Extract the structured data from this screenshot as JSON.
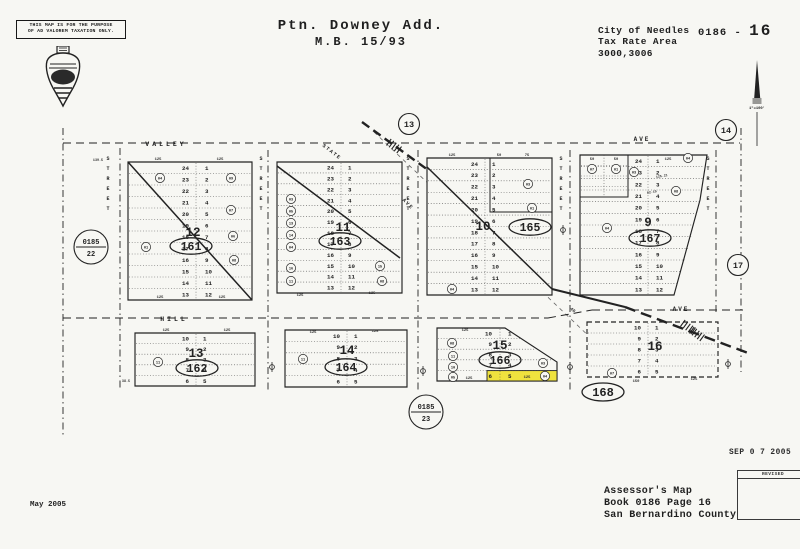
{
  "header": {
    "disclaimer": {
      "line1": "THIS MAP IS FOR THE PURPOSE",
      "line2": "OF AD VALOREM TAXATION ONLY."
    },
    "title": {
      "line1": "Ptn. Downey Add.",
      "line2": "M.B. 15/93"
    },
    "agency": [
      "City of Needles",
      "Tax Rate Area",
      "3000,3006"
    ],
    "sheet": {
      "prefix": "0186 -",
      "number": "16"
    }
  },
  "footer": {
    "date_note": "May 2005",
    "stamp_date": "SEP 0 7 2005",
    "revised_label": "REVISED",
    "credit": [
      "Assessor's Map",
      "Book 0186 Page 16",
      "San Bernardino County"
    ]
  },
  "map": {
    "ink": "#222222",
    "paper": "#f7f7f3",
    "highlight_color": "#efe23e",
    "scale_label": "1\"=100'",
    "streets": {
      "horizontal_labels": [
        {
          "text": "VALLEY",
          "x": 166,
          "y": 146,
          "size": 6.5,
          "ls": 3
        },
        {
          "text": "AVE",
          "x": 642,
          "y": 141,
          "size": 6,
          "ls": 2
        },
        {
          "text": "HILL",
          "x": 174,
          "y": 321,
          "size": 6.5,
          "ls": 3
        },
        {
          "text": "AVE",
          "x": 681,
          "y": 311,
          "size": 6,
          "ls": 2
        }
      ],
      "vertical_street_word": "STREET",
      "vertical_columns": [
        108,
        261,
        408,
        561,
        708
      ],
      "diagonal_labels": [
        {
          "text": "STATE",
          "x": 331,
          "y": 153,
          "rot": 38,
          "size": 5
        },
        {
          "text": "AVE",
          "x": 407,
          "y": 205,
          "rot": 45,
          "size": 5
        }
      ],
      "lines_h": [
        [
          63,
          143,
          740,
          143
        ],
        [
          63,
          318,
          548,
          318
        ],
        [
          548,
          318,
          592,
          310
        ],
        [
          592,
          310,
          744,
          310
        ]
      ],
      "lines_v": [
        [
          63,
          128,
          63,
          438
        ],
        [
          120,
          148,
          120,
          390
        ],
        [
          268,
          150,
          268,
          390
        ],
        [
          418,
          150,
          418,
          390
        ],
        [
          570,
          150,
          570,
          390
        ],
        [
          716,
          150,
          716,
          314
        ],
        [
          741,
          128,
          741,
          372
        ]
      ]
    },
    "diag_light": [
      [
        374,
        132
      ],
      [
        614,
        360
      ]
    ],
    "highway_solid": [
      [
        552,
        289
      ],
      [
        625,
        307
      ]
    ],
    "highway_dashed": [
      [
        625,
        307
      ],
      [
        748,
        353
      ]
    ],
    "rail_dashed": [
      [
        362,
        122
      ],
      [
        428,
        170
      ]
    ],
    "hatches": [
      {
        "x": 394,
        "y": 146,
        "a": 36
      },
      {
        "x": 688,
        "y": 327,
        "a": 36
      },
      {
        "x": 697,
        "y": 334,
        "a": 36
      }
    ],
    "symbols": [
      [
        272,
        367
      ],
      [
        423,
        371
      ],
      [
        570,
        367
      ],
      [
        728,
        364
      ],
      [
        563,
        230
      ]
    ],
    "node_circles": [
      {
        "label": "13",
        "x": 409,
        "y": 124
      },
      {
        "label": "14",
        "x": 726,
        "y": 130
      },
      {
        "label": "17",
        "x": 738,
        "y": 265
      }
    ],
    "ref_circles": [
      {
        "top": "0185",
        "bottom": "22",
        "x": 91,
        "y": 247
      },
      {
        "top": "0185",
        "bottom": "23",
        "x": 426,
        "y": 412
      }
    ],
    "oval_labels": [
      {
        "text": "168",
        "x": 603,
        "y": 392
      }
    ],
    "dims": [
      {
        "t": "125",
        "x": 158,
        "y": 160
      },
      {
        "t": "125",
        "x": 220,
        "y": 160
      },
      {
        "t": "139.5",
        "x": 98,
        "y": 161,
        "s": 3.4
      },
      {
        "t": "125",
        "x": 160,
        "y": 298
      },
      {
        "t": "125",
        "x": 222,
        "y": 298
      },
      {
        "t": "125",
        "x": 300,
        "y": 296
      },
      {
        "t": "125",
        "x": 372,
        "y": 294
      },
      {
        "t": "125",
        "x": 452,
        "y": 156
      },
      {
        "t": "50",
        "x": 499,
        "y": 156
      },
      {
        "t": "75",
        "x": 527,
        "y": 156
      },
      {
        "t": "50",
        "x": 592,
        "y": 160
      },
      {
        "t": "50",
        "x": 616,
        "y": 160
      },
      {
        "t": "125",
        "x": 668,
        "y": 160
      },
      {
        "t": "125.21",
        "x": 662,
        "y": 177,
        "r": -10,
        "s": 3.3
      },
      {
        "t": "82.15",
        "x": 652,
        "y": 193,
        "r": -10,
        "s": 3.3
      },
      {
        "t": "125",
        "x": 166,
        "y": 331
      },
      {
        "t": "125",
        "x": 227,
        "y": 331
      },
      {
        "t": "125",
        "x": 313,
        "y": 333
      },
      {
        "t": "125",
        "x": 375,
        "y": 332
      },
      {
        "t": "125",
        "x": 465,
        "y": 331
      },
      {
        "t": "125",
        "x": 469,
        "y": 379
      },
      {
        "t": "125",
        "x": 527,
        "y": 378
      },
      {
        "t": "150",
        "x": 636,
        "y": 382
      },
      {
        "t": "125",
        "x": 694,
        "y": 380
      },
      {
        "t": "40",
        "x": 572,
        "y": 311,
        "r": 40,
        "s": 4.5
      },
      {
        "t": "38.5",
        "x": 126,
        "y": 382,
        "s": 3.4
      }
    ],
    "blocks": [
      {
        "apn": "161",
        "block_no": "12",
        "style": "solid",
        "poly": [
          [
            128,
            162
          ],
          [
            252,
            162
          ],
          [
            252,
            300
          ],
          [
            128,
            300
          ]
        ],
        "top": 162,
        "bottom": 300,
        "gx1": 128,
        "gx2": 252,
        "cx": 196,
        "lx": 189,
        "rx": 205,
        "rows": [
          [
            "24",
            "1"
          ],
          [
            "23",
            "2"
          ],
          [
            "22",
            "3"
          ],
          [
            "21",
            "4"
          ],
          [
            "20",
            "5"
          ],
          [
            "19",
            "6"
          ],
          [
            "18",
            "7"
          ],
          [
            "17",
            "8"
          ],
          [
            "16",
            "9"
          ],
          [
            "15",
            "10"
          ],
          [
            "14",
            "11"
          ],
          [
            "13",
            "12"
          ]
        ],
        "ellipse": {
          "x": 191,
          "y": 246
        },
        "big": {
          "x": 193,
          "y": 236
        },
        "diag": [
          [
            128,
            162
          ],
          [
            252,
            300
          ]
        ],
        "circles": [
          {
            "t": "04",
            "x": 160,
            "y": 178
          },
          {
            "t": "09",
            "x": 231,
            "y": 178
          },
          {
            "t": "07",
            "x": 231,
            "y": 210
          },
          {
            "t": "06",
            "x": 233,
            "y": 236
          },
          {
            "t": "01",
            "x": 146,
            "y": 247
          },
          {
            "t": "08",
            "x": 234,
            "y": 260
          }
        ]
      },
      {
        "apn": "163",
        "block_no": "11",
        "style": "solid",
        "poly": [
          [
            277,
            162
          ],
          [
            402,
            162
          ],
          [
            402,
            293
          ],
          [
            277,
            293
          ]
        ],
        "top": 162,
        "bottom": 293,
        "gx1": 277,
        "gx2": 402,
        "cx": 341,
        "lx": 334,
        "rx": 348,
        "rows": [
          [
            "24",
            "1"
          ],
          [
            "23",
            "2"
          ],
          [
            "22",
            "3"
          ],
          [
            "21",
            "4"
          ],
          [
            "20",
            "5"
          ],
          [
            "19",
            "6"
          ],
          [
            "18",
            "7"
          ],
          [
            "17",
            "8"
          ],
          [
            "16",
            "9"
          ],
          [
            "15",
            "10"
          ],
          [
            "14",
            "11"
          ],
          [
            "13",
            "12"
          ]
        ],
        "ellipse": {
          "x": 340,
          "y": 241
        },
        "big": {
          "x": 343,
          "y": 231
        },
        "diag": [
          [
            277,
            166
          ],
          [
            400,
            258
          ]
        ],
        "circles": [
          {
            "t": "03",
            "x": 291,
            "y": 199
          },
          {
            "t": "05",
            "x": 291,
            "y": 211
          },
          {
            "t": "13",
            "x": 291,
            "y": 223
          },
          {
            "t": "14",
            "x": 291,
            "y": 235
          },
          {
            "t": "04",
            "x": 291,
            "y": 247
          },
          {
            "t": "16",
            "x": 291,
            "y": 268
          },
          {
            "t": "11",
            "x": 291,
            "y": 281
          },
          {
            "t": "15",
            "x": 380,
            "y": 266
          },
          {
            "t": "08",
            "x": 382,
            "y": 281
          }
        ]
      },
      {
        "apn": "165",
        "block_no": "10",
        "style": "solid",
        "poly": [
          [
            427,
            158
          ],
          [
            552,
            158
          ],
          [
            552,
            295
          ],
          [
            427,
            295
          ]
        ],
        "top": 158,
        "bottom": 295,
        "gx1": 427,
        "gx2": 552,
        "cx": 485,
        "lx": 478,
        "rx": 492,
        "rows": [
          [
            "24",
            "1"
          ],
          [
            "23",
            "2"
          ],
          [
            "22",
            "3"
          ],
          [
            "21",
            "4"
          ],
          [
            "20",
            "5"
          ],
          [
            "19",
            "6"
          ],
          [
            "18",
            "7"
          ],
          [
            "17",
            "8"
          ],
          [
            "16",
            "9"
          ],
          [
            "15",
            "10"
          ],
          [
            "14",
            "11"
          ],
          [
            "13",
            "12"
          ]
        ],
        "ellipse": {
          "x": 530,
          "y": 227
        },
        "big": {
          "x": 483,
          "y": 230
        },
        "diag": [
          [
            427,
            167
          ],
          [
            552,
            289
          ]
        ],
        "subrect": [
          490,
          158,
          62,
          54
        ],
        "circles": [
          {
            "t": "03",
            "x": 528,
            "y": 184
          },
          {
            "t": "01",
            "x": 532,
            "y": 208
          },
          {
            "t": "04",
            "x": 452,
            "y": 289
          }
        ]
      },
      {
        "apn": "167",
        "block_no": "9",
        "style": "solid",
        "poly": [
          [
            580,
            155
          ],
          [
            707,
            155
          ],
          [
            700,
            200
          ],
          [
            674,
            295
          ],
          [
            580,
            295
          ]
        ],
        "top": 155,
        "bottom": 295,
        "gx1": 580,
        "gx2": 707,
        "cx": 648,
        "lx": 642,
        "rx": 656,
        "row_x2": [
          705,
          705,
          704,
          702,
          699,
          696,
          693,
          689,
          686,
          682,
          679
        ],
        "rows": [
          [
            "24",
            "1"
          ],
          [
            "23",
            "2"
          ],
          [
            "22",
            "3"
          ],
          [
            "21",
            "4"
          ],
          [
            "20",
            "5"
          ],
          [
            "19",
            "6"
          ],
          [
            "18",
            "7"
          ],
          [
            "17",
            "8"
          ],
          [
            "16",
            "9"
          ],
          [
            "15",
            "10"
          ],
          [
            "14",
            "11"
          ],
          [
            "13",
            "12"
          ]
        ],
        "ellipse": {
          "x": 650,
          "y": 238
        },
        "big": {
          "x": 648,
          "y": 226
        },
        "subrect": [
          580,
          155,
          48,
          42
        ],
        "subdiv": 604,
        "subrows": [
          165.5,
          176,
          186.5
        ],
        "circles": [
          {
            "t": "07",
            "x": 592,
            "y": 169
          },
          {
            "t": "01",
            "x": 616,
            "y": 169
          },
          {
            "t": "03",
            "x": 634,
            "y": 172
          },
          {
            "t": "04",
            "x": 688,
            "y": 158
          },
          {
            "t": "08",
            "x": 676,
            "y": 191
          },
          {
            "t": "04",
            "x": 607,
            "y": 228
          }
        ]
      },
      {
        "apn": "162",
        "block_no": "13",
        "style": "solid",
        "poly": [
          [
            135,
            333
          ],
          [
            255,
            333
          ],
          [
            255,
            386
          ],
          [
            135,
            386
          ]
        ],
        "top": 333,
        "bottom": 386,
        "gx1": 135,
        "gx2": 255,
        "cx": 196,
        "lx": 189,
        "rx": 203,
        "rows": [
          [
            "10",
            "1"
          ],
          [
            "9",
            "2"
          ],
          [
            "8",
            "3"
          ],
          [
            "7",
            "4"
          ],
          [
            "6",
            "5"
          ]
        ],
        "ellipse": {
          "x": 197,
          "y": 368
        },
        "big": {
          "x": 196,
          "y": 357
        },
        "circles": [
          {
            "t": "11",
            "x": 158,
            "y": 362
          }
        ]
      },
      {
        "apn": "164",
        "block_no": "14",
        "style": "solid",
        "poly": [
          [
            285,
            330
          ],
          [
            407,
            330
          ],
          [
            407,
            387
          ],
          [
            285,
            387
          ]
        ],
        "top": 330,
        "bottom": 387,
        "gx1": 285,
        "gx2": 407,
        "cx": 347,
        "lx": 340,
        "rx": 354,
        "rows": [
          [
            "10",
            "1"
          ],
          [
            "9",
            "2"
          ],
          [
            "8",
            "3"
          ],
          [
            "7",
            "4"
          ],
          [
            "6",
            "5"
          ]
        ],
        "ellipse": {
          "x": 346,
          "y": 367
        },
        "big": {
          "x": 347,
          "y": 354
        },
        "circles": [
          {
            "t": "11",
            "x": 303,
            "y": 359
          }
        ]
      },
      {
        "apn": "166",
        "block_no": "15",
        "style": "solid",
        "poly": [
          [
            437,
            328
          ],
          [
            505,
            328
          ],
          [
            557,
            362
          ],
          [
            557,
            381
          ],
          [
            437,
            381
          ]
        ],
        "top": 328,
        "bottom": 381,
        "gx1": 437,
        "gx2": 557,
        "cx": 500,
        "lx": 492,
        "rx": 508,
        "row_x2": [
          521,
          537,
          553,
          557
        ],
        "rows": [
          [
            "10",
            "1"
          ],
          [
            "9",
            "2"
          ],
          [
            "8",
            "3"
          ],
          [
            "7",
            "4"
          ],
          [
            "6",
            "5"
          ]
        ],
        "ellipse": {
          "x": 500,
          "y": 360
        },
        "big": {
          "x": 500,
          "y": 349
        },
        "highlight": {
          "x": 487,
          "y": 370.6,
          "w": 70,
          "h": 10.4
        },
        "circles": [
          {
            "t": "08",
            "x": 452,
            "y": 343
          },
          {
            "t": "11",
            "x": 453,
            "y": 356
          },
          {
            "t": "10",
            "x": 453,
            "y": 367
          },
          {
            "t": "05",
            "x": 453,
            "y": 377
          },
          {
            "t": "03",
            "x": 543,
            "y": 363
          },
          {
            "t": "04",
            "x": 545,
            "y": 376
          }
        ]
      },
      {
        "apn": "168",
        "block_no": "16",
        "style": "dashed",
        "poly": [
          [
            587,
            322
          ],
          [
            718,
            322
          ],
          [
            718,
            377
          ],
          [
            587,
            377
          ]
        ],
        "top": 322,
        "bottom": 377,
        "gx1": 587,
        "gx2": 718,
        "cx": 648,
        "lx": 641,
        "rx": 655,
        "rows": [
          [
            "10",
            "1"
          ],
          [
            "9",
            "2"
          ],
          [
            "8",
            "3"
          ],
          [
            "7",
            "4"
          ],
          [
            "6",
            "5"
          ]
        ],
        "big": {
          "x": 655,
          "y": 350
        },
        "circles": [
          {
            "t": "07",
            "x": 612,
            "y": 373
          }
        ]
      }
    ]
  }
}
